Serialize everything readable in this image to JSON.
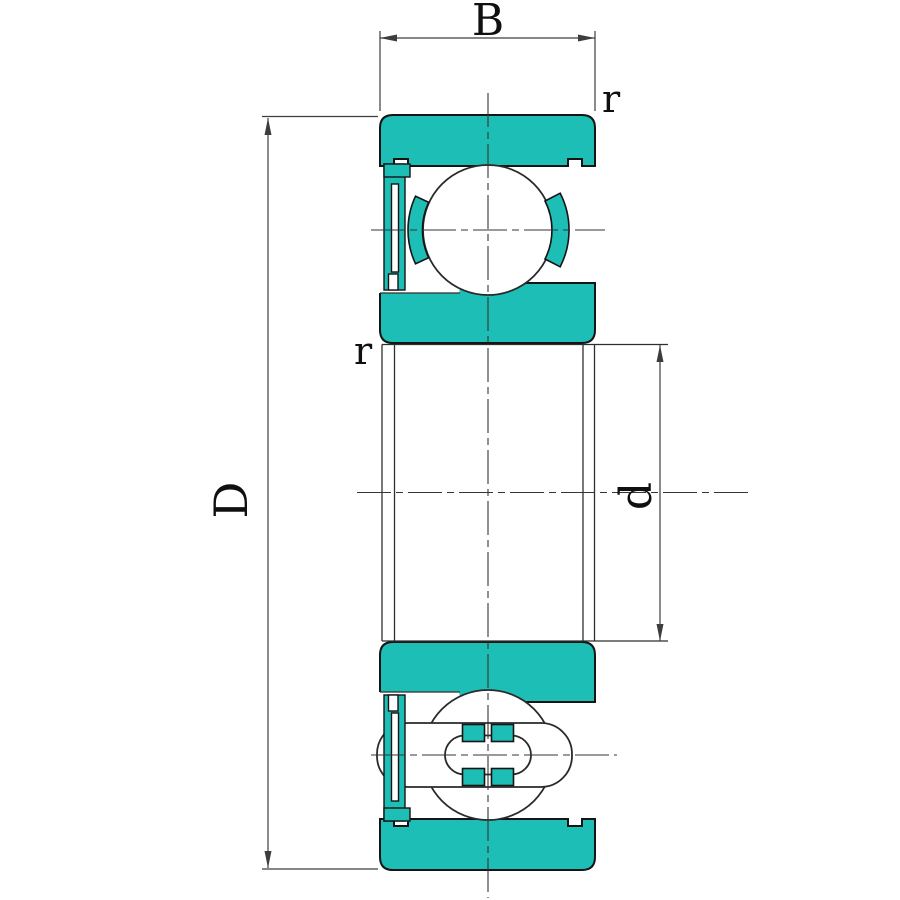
{
  "drawing": {
    "labels": {
      "width": "B",
      "outer_diameter": "D",
      "bore_diameter": "d",
      "corner_radius_top": "r",
      "corner_radius_inner": "r"
    },
    "colors": {
      "ring_fill": "#1cbeb5",
      "outline": "#141414",
      "dimension_line": "#3d3d3d",
      "background": "#ffffff"
    }
  }
}
